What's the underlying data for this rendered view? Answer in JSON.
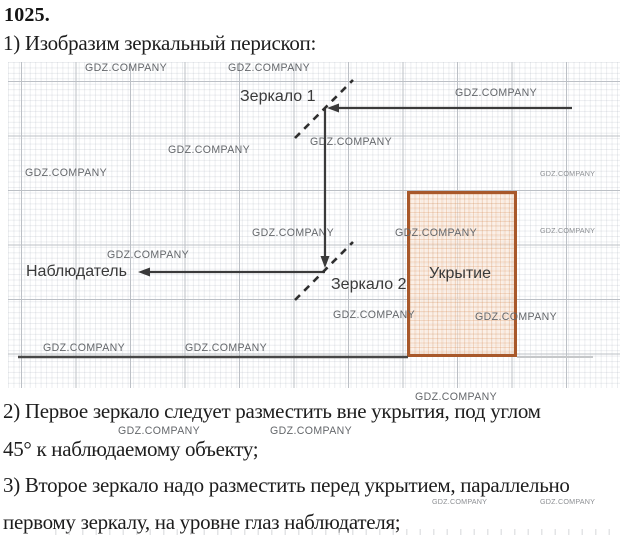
{
  "header": {
    "problem_number": "1025.",
    "step1": "1) Изобразим зеркальный перископ:"
  },
  "diagram": {
    "mirror1_label": "Зеркало 1",
    "mirror2_label": "Зеркало 2",
    "observer_label": "Наблюдатель",
    "shelter_label": "Укрытие"
  },
  "solution": {
    "step2_line1": "2) Первое зеркало следует разместить вне укрытия, под углом",
    "step2_line2": "45° к наблюдаемому объекту;",
    "step3_line1": "3) Второе зеркало надо разместить перед укрытием, параллельно",
    "step3_line2": "первому зеркалу, на уровне глаз наблюдателя;"
  },
  "watermark": {
    "text": "GDZ.COMPANY"
  },
  "colors": {
    "ray": "#3a3a3a",
    "mirror_dash": "#2e2e2e",
    "shelter_border": "#a8582a",
    "shelter_fill": "#fae7d8",
    "ground": "#474747",
    "grid_major": "#bcc0c6"
  }
}
